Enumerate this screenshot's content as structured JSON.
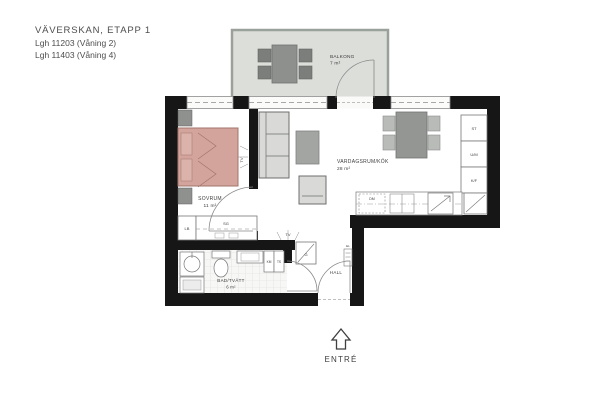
{
  "header": {
    "project": "VÄVERSKAN, ETAPP 1",
    "apartment_line1": "Lgh 11203 (Våning 2)",
    "apartment_line2": "Lgh 11403 (Våning 4)"
  },
  "rooms": {
    "balcony": {
      "name": "BALKONG",
      "area": "7 m²"
    },
    "bedroom": {
      "name": "SOVRUM",
      "area": "11 m²"
    },
    "living": {
      "name": "VARDAGSRUM/KÖK",
      "area": "28 m²"
    },
    "bath": {
      "name": "BAD/TVÄTT",
      "area": "6 m²"
    },
    "hall": {
      "name": "HALL"
    }
  },
  "labels": {
    "entrance": "ENTRÉ",
    "tv": "TV",
    "linen_cabinet": "LB",
    "sliding_wardrobe": "SG",
    "wardrobe": "G",
    "cleaning_cabinet": "ST",
    "oven_micro": "U/M",
    "fridge_freezer": "K/F",
    "dishwasher": "DM",
    "washer": "KM",
    "drying_cabinet": "TS",
    "electrical": "EL"
  },
  "colors": {
    "wall": "#161616",
    "bed": "#d2a49c",
    "balcony_floor": "#dcdeda",
    "furniture_light": "#d9dad8",
    "furniture_dark": "#8f918f",
    "line": "#777777"
  }
}
